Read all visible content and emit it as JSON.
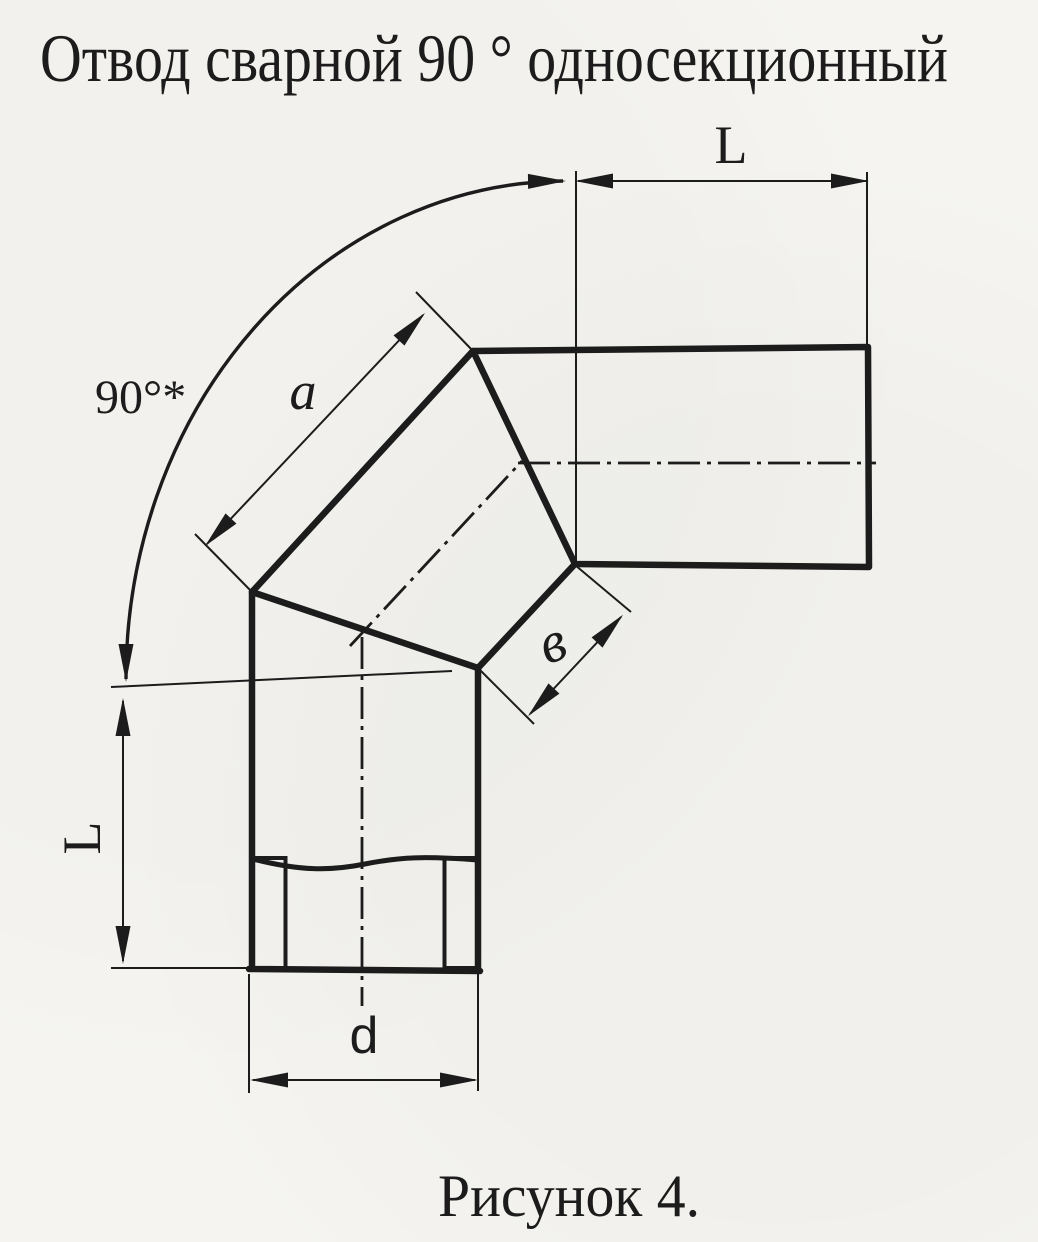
{
  "document": {
    "title": "Отвод сварной 90 ° односекционный",
    "figure_caption": "Рисунок 4."
  },
  "drawing": {
    "labels": {
      "angle": "90°*",
      "length_top": "L",
      "length_left": "L",
      "section_outer": "a",
      "section_inner": "в",
      "diameter": "d"
    },
    "colors": {
      "ink": "#1c1c1c",
      "paper": "#f5f4f0"
    }
  }
}
